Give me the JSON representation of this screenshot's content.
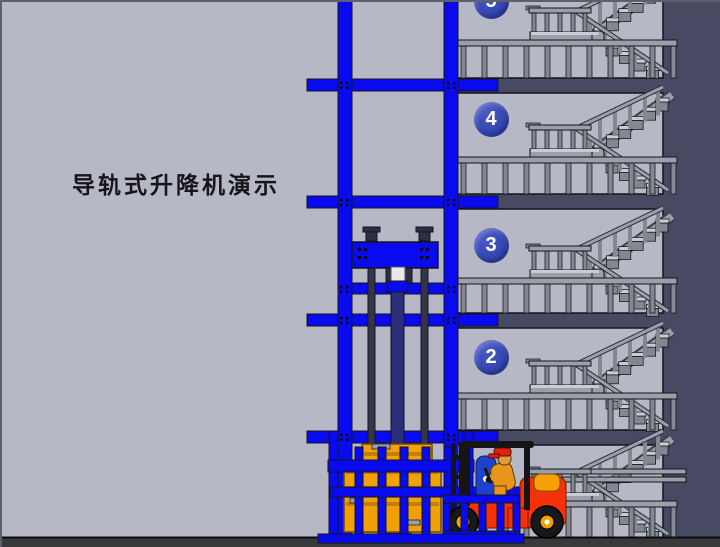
{
  "title": "导轨式升降机演示",
  "building": {
    "floors": [
      {
        "label": "5"
      },
      {
        "label": "4"
      },
      {
        "label": "3"
      },
      {
        "label": "2"
      },
      {
        "label": ""
      }
    ]
  },
  "colors": {
    "background": "#b6b8c6",
    "wall_dark": "#474a62",
    "outline": "#14151c",
    "rail_blue": "#0a0af0",
    "cylinder_navy": "#2b2e79",
    "badge_blue": "#3142b0",
    "badge_blue_light": "#4a5ac2",
    "stair_gray": "#9aa0a9",
    "stair_gray_dark": "#83878f",
    "stair_gray_light": "#c9ccd3",
    "ground": "#39393b",
    "pallet_yellow": "#f2a007",
    "pallet_stripe": "#c57f00",
    "forklift_red": "#f43108",
    "engine_orange": "#f7a008",
    "wheel_hub_orange": "#f0a000",
    "driver_skin": "#e09a40",
    "driver_shirt": "#e8951d",
    "driver_cap": "#e02010",
    "seat_blue": "#1d43cc"
  }
}
